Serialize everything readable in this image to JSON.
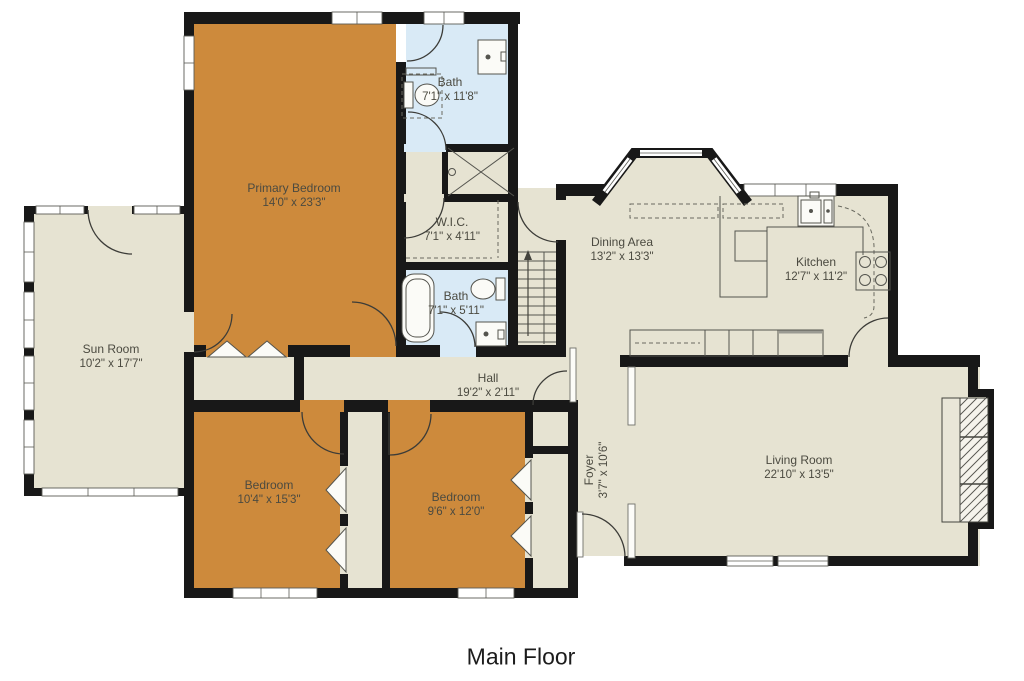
{
  "caption": "Main Floor",
  "colors": {
    "bedroom": "#cd8a3c",
    "room": "#e6e3d2",
    "bath": "#d9eaf6",
    "wall": "#181818",
    "label": "#4b4a40"
  },
  "rooms": [
    {
      "name": "Primary Bedroom",
      "dims": "14'0\" x 23'3\""
    },
    {
      "name": "Bath",
      "dims": "7'1\" x 11'8\""
    },
    {
      "name": "W.I.C.",
      "dims": "7'1\" x 4'11\""
    },
    {
      "name": "Bath",
      "dims": "7'1\" x 5'11\""
    },
    {
      "name": "Sun Room",
      "dims": "10'2\" x 17'7\""
    },
    {
      "name": "Dining Area",
      "dims": "13'2\" x 13'3\""
    },
    {
      "name": "Kitchen",
      "dims": "12'7\" x 11'2\""
    },
    {
      "name": "Hall",
      "dims": "19'2\" x 2'11\""
    },
    {
      "name": "Bedroom",
      "dims": "10'4\" x 15'3\""
    },
    {
      "name": "Bedroom",
      "dims": "9'6\" x 12'0\""
    },
    {
      "name": "Foyer",
      "dims": "3'7\" x 10'6\""
    },
    {
      "name": "Living Room",
      "dims": "22'10\" x 13'5\""
    }
  ]
}
